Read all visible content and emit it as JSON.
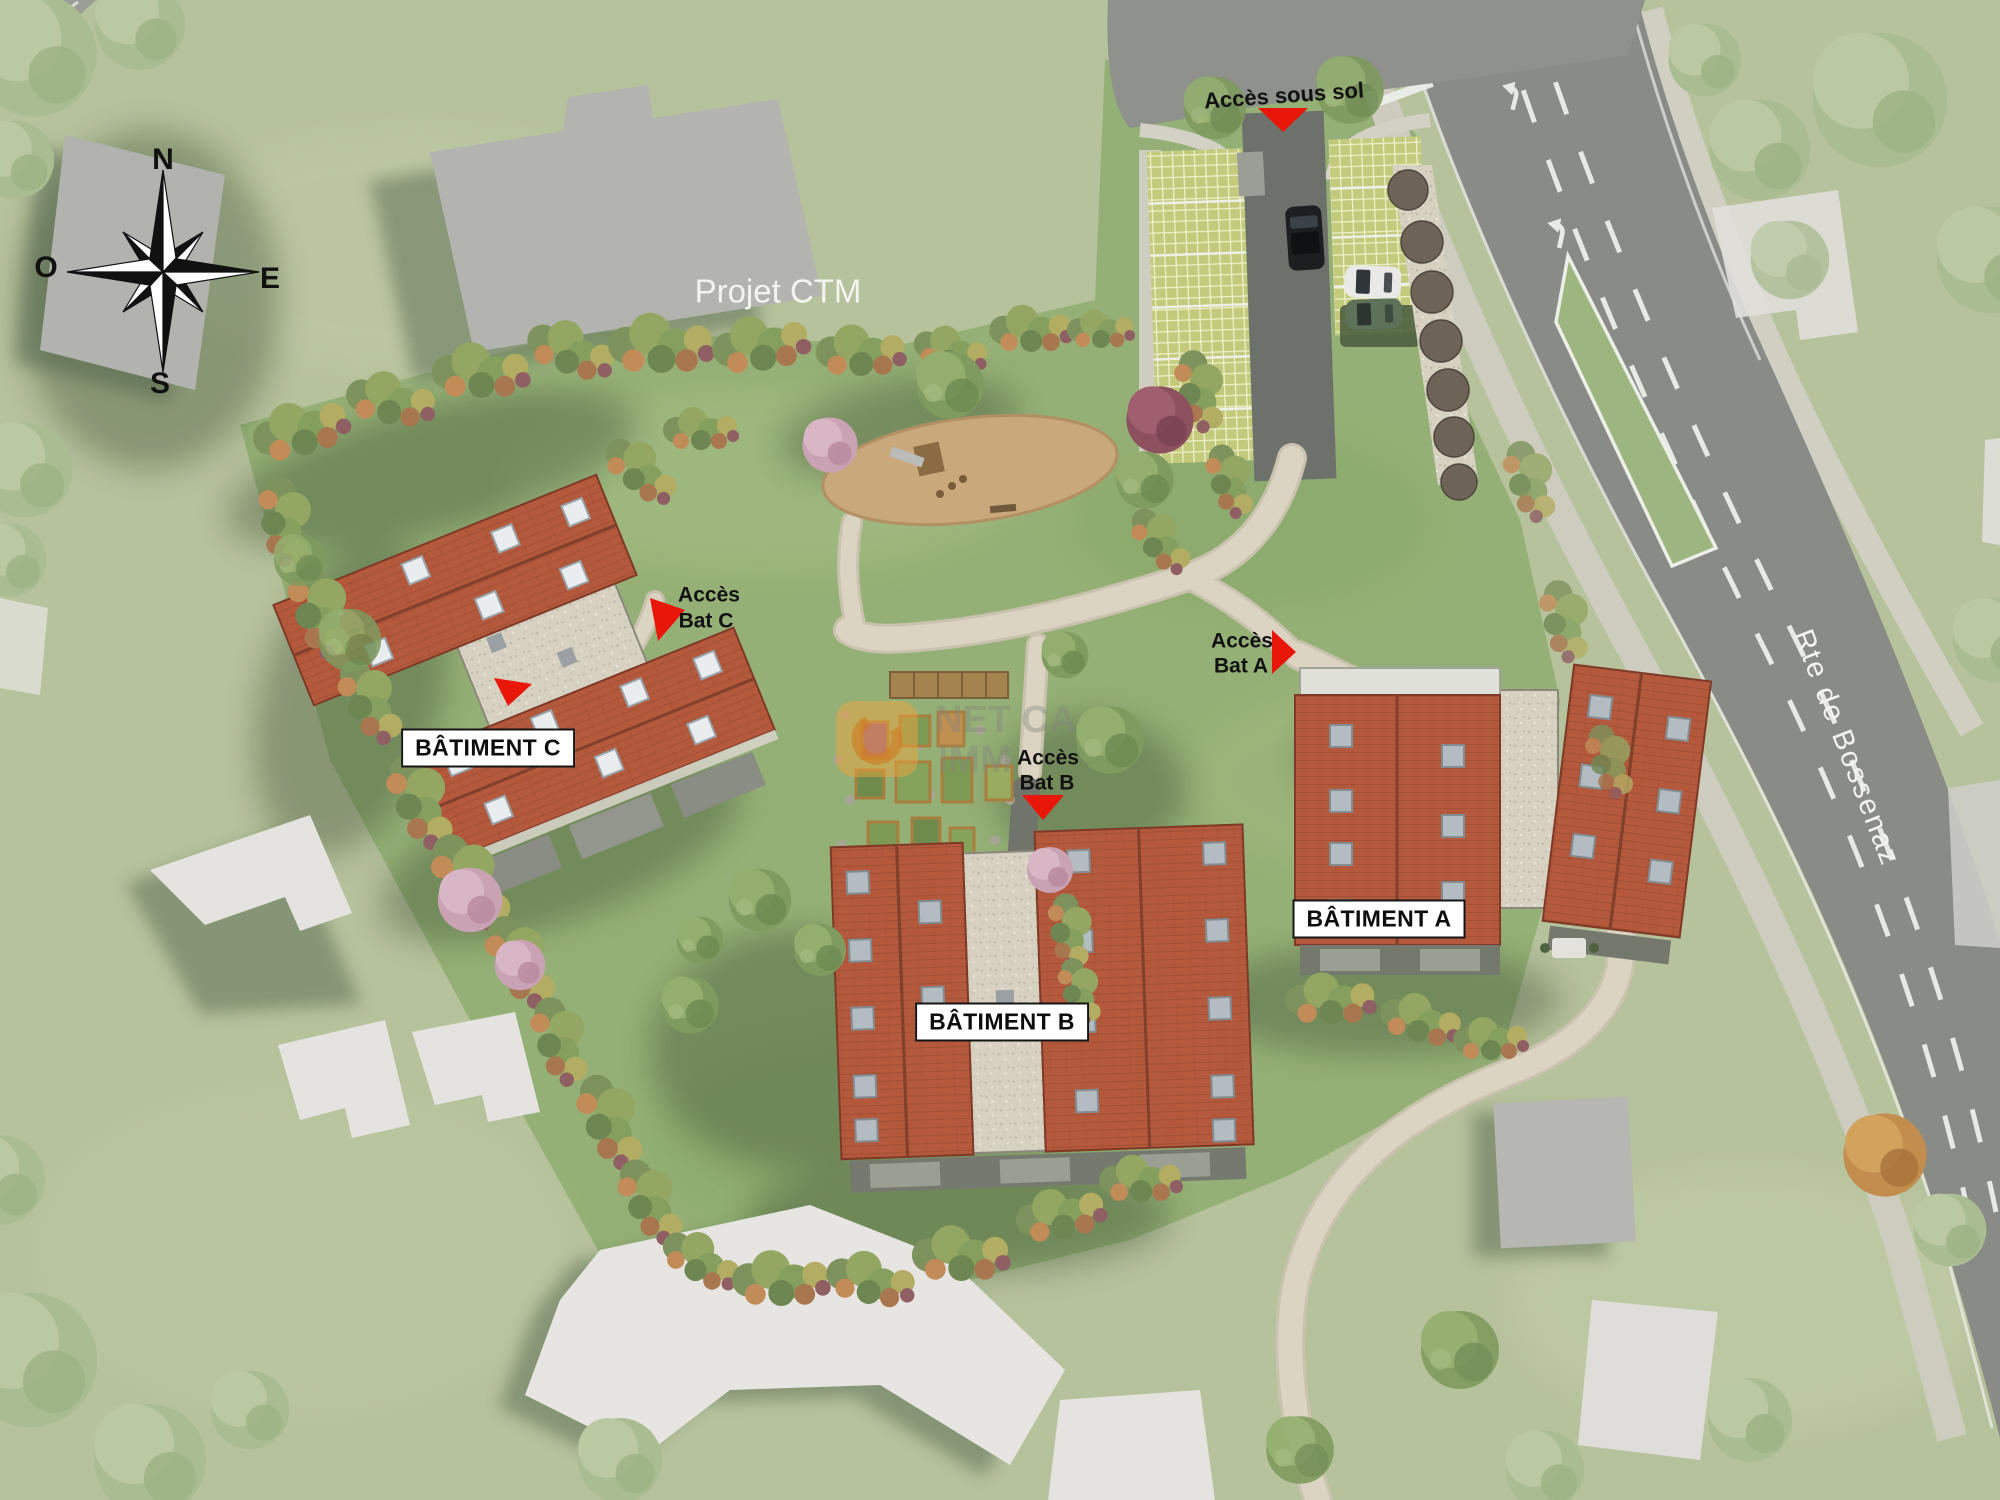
{
  "labels": {
    "project_neighbor": "Projet CTM",
    "road": "Rte de Bossenaz",
    "access_basement": "Accès sous sol",
    "access_line1": "Accès",
    "access_a_line2": "Bat A",
    "access_b_line2": "Bat B",
    "access_c_line2": "Bat C",
    "building_a": "BÂTIMENT A",
    "building_b": "BÂTIMENT B",
    "building_c": "BÂTIMENT C"
  },
  "compass": {
    "n": "N",
    "e": "E",
    "s": "S",
    "w": "O"
  },
  "watermark": {
    "line1": "NET CA",
    "line2": "IMM"
  },
  "colors": {
    "marker_red": "#e9160a",
    "roof_red": "#b4593c",
    "road_gray": "#898b86",
    "path_beige": "#d9d2c0",
    "lawn_green": "#95b076",
    "neighbor_gray": "#b5b6b2"
  }
}
